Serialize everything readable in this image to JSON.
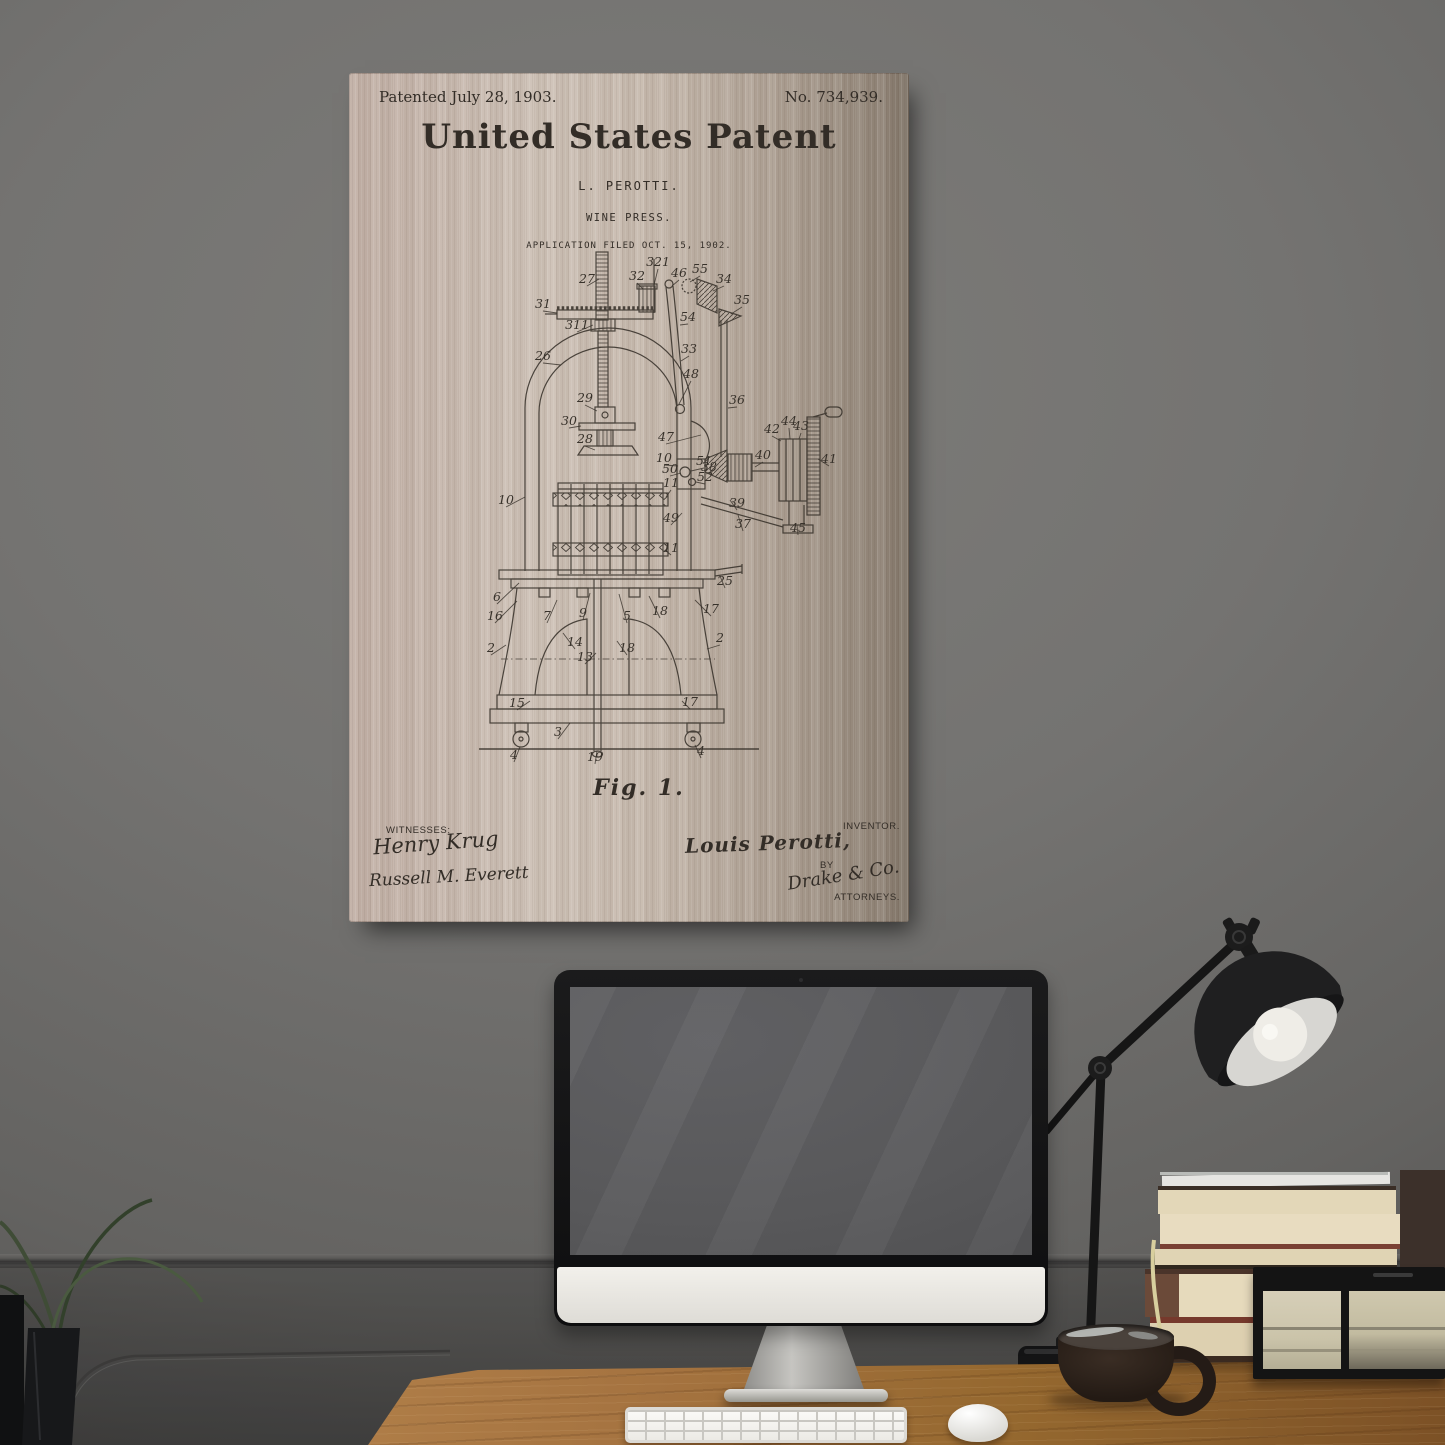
{
  "scene": {
    "description": "Wine press patent art print on brushed metal hanging on a dark gray wall above a desk with a computer, lamp, books, glass box, mug and plant",
    "objects": [
      "patent print",
      "desktop computer",
      "keyboard",
      "mouse",
      "desk lamp",
      "book stack",
      "glass display box",
      "coffee mug",
      "plant"
    ]
  },
  "colors": {
    "wall": "#747371",
    "wainscot": "#4e4d4c",
    "desk_wood": "#a57340",
    "poster_background": "#c8bbb0",
    "ink": "#38322b",
    "imac_bezel": "#141415",
    "imac_screen": "#58585a",
    "imac_chin": "#ece9e4",
    "lamp": "#1b1b1b",
    "bulb": "#efede7",
    "book_pages": "#e6dabc",
    "book_cover_red": "#77392c",
    "mug": "#2e241d",
    "glass_box_glass": "#cfc8ae"
  },
  "patent_print": {
    "header_left": "Patented July 28, 1903.",
    "header_right": "No. 734,939.",
    "title": "United States Patent",
    "inventor_name_line": "L. PEROTTI.",
    "invention_title": "WINE PRESS.",
    "application_line": "APPLICATION FILED OCT. 15, 1902.",
    "figure_label": "Fig. 1.",
    "witnesses_label": "WITNESSES:",
    "witness_signatures": [
      "Henry Krug",
      "Russell M. Everett"
    ],
    "inventor_label": "INVENTOR.",
    "inventor_signature": "Louis Perotti,",
    "by_label": "BY",
    "attorney_signature": "Drake & Co.",
    "attorneys_label": "ATTORNEYS.",
    "part_labels": [
      {
        "n": "27",
        "x": 238,
        "y": 210,
        "lx": 250,
        "ly": 206
      },
      {
        "n": "31",
        "x": 194,
        "y": 235,
        "lx": 208,
        "ly": 240
      },
      {
        "n": "311",
        "x": 228,
        "y": 256,
        "lx": 244,
        "ly": 252
      },
      {
        "n": "321",
        "x": 309,
        "y": 193,
        "lx": 305,
        "ly": 212
      },
      {
        "n": "32",
        "x": 288,
        "y": 207,
        "lx": 294,
        "ly": 216
      },
      {
        "n": "46",
        "x": 330,
        "y": 204,
        "lx": 323,
        "ly": 213
      },
      {
        "n": "55",
        "x": 351,
        "y": 200,
        "lx": 341,
        "ly": 209
      },
      {
        "n": "34",
        "x": 375,
        "y": 210,
        "lx": 364,
        "ly": 218
      },
      {
        "n": "35",
        "x": 393,
        "y": 231,
        "lx": 382,
        "ly": 241
      },
      {
        "n": "54",
        "x": 339,
        "y": 248,
        "lx": 331,
        "ly": 252
      },
      {
        "n": "26",
        "x": 194,
        "y": 287,
        "lx": 212,
        "ly": 292
      },
      {
        "n": "33",
        "x": 340,
        "y": 280,
        "lx": 332,
        "ly": 288
      },
      {
        "n": "48",
        "x": 342,
        "y": 305,
        "lx": 330,
        "ly": 331
      },
      {
        "n": "36",
        "x": 388,
        "y": 331,
        "lx": 379,
        "ly": 335
      },
      {
        "n": "29",
        "x": 236,
        "y": 329,
        "lx": 248,
        "ly": 338
      },
      {
        "n": "30",
        "x": 220,
        "y": 352,
        "lx": 232,
        "ly": 353
      },
      {
        "n": "28",
        "x": 236,
        "y": 370,
        "lx": 246,
        "ly": 377
      },
      {
        "n": "47",
        "x": 317,
        "y": 368,
        "lx": 352,
        "ly": 362
      },
      {
        "n": "10",
        "x": 315,
        "y": 389,
        "lx": 329,
        "ly": 393
      },
      {
        "n": "51",
        "x": 355,
        "y": 392,
        "lx": 342,
        "ly": 398
      },
      {
        "n": "50",
        "x": 321,
        "y": 400,
        "lx": 332,
        "ly": 400
      },
      {
        "n": "52",
        "x": 356,
        "y": 408,
        "lx": 347,
        "ly": 409
      },
      {
        "n": "11",
        "x": 322,
        "y": 414,
        "lx": 317,
        "ly": 424
      },
      {
        "n": "49",
        "x": 322,
        "y": 449,
        "lx": 333,
        "ly": 440
      },
      {
        "n": "10",
        "x": 157,
        "y": 431,
        "lx": 176,
        "ly": 424
      },
      {
        "n": "11",
        "x": 322,
        "y": 479,
        "lx": 316,
        "ly": 477
      },
      {
        "n": "38",
        "x": 360,
        "y": 398,
        "lx": 366,
        "ly": 396
      },
      {
        "n": "40",
        "x": 414,
        "y": 386,
        "lx": 406,
        "ly": 394
      },
      {
        "n": "44",
        "x": 440,
        "y": 352,
        "lx": 441,
        "ly": 366
      },
      {
        "n": "43",
        "x": 452,
        "y": 357,
        "lx": 450,
        "ly": 366
      },
      {
        "n": "42",
        "x": 423,
        "y": 360,
        "lx": 432,
        "ly": 368
      },
      {
        "n": "41",
        "x": 480,
        "y": 390,
        "lx": 469,
        "ly": 386
      },
      {
        "n": "39",
        "x": 388,
        "y": 434,
        "lx": 381,
        "ly": 427
      },
      {
        "n": "37",
        "x": 394,
        "y": 455,
        "lx": 389,
        "ly": 442
      },
      {
        "n": "45",
        "x": 449,
        "y": 459,
        "lx": 448,
        "ly": 452
      },
      {
        "n": "25",
        "x": 376,
        "y": 512,
        "lx": 371,
        "ly": 503
      },
      {
        "n": "6",
        "x": 148,
        "y": 528,
        "lx": 170,
        "ly": 510
      },
      {
        "n": "16",
        "x": 146,
        "y": 547,
        "lx": 168,
        "ly": 528
      },
      {
        "n": "7",
        "x": 198,
        "y": 547,
        "lx": 208,
        "ly": 527
      },
      {
        "n": "9",
        "x": 234,
        "y": 544,
        "lx": 241,
        "ly": 520
      },
      {
        "n": "5",
        "x": 278,
        "y": 547,
        "lx": 270,
        "ly": 521
      },
      {
        "n": "18",
        "x": 311,
        "y": 542,
        "lx": 300,
        "ly": 523
      },
      {
        "n": "17",
        "x": 362,
        "y": 540,
        "lx": 346,
        "ly": 527
      },
      {
        "n": "2",
        "x": 142,
        "y": 579,
        "lx": 157,
        "ly": 572
      },
      {
        "n": "2",
        "x": 371,
        "y": 569,
        "lx": 358,
        "ly": 576
      },
      {
        "n": "14",
        "x": 226,
        "y": 573,
        "lx": 214,
        "ly": 560
      },
      {
        "n": "13",
        "x": 236,
        "y": 588,
        "lx": 247,
        "ly": 580
      },
      {
        "n": "18",
        "x": 278,
        "y": 579,
        "lx": 268,
        "ly": 568
      },
      {
        "n": "15",
        "x": 168,
        "y": 634,
        "lx": 181,
        "ly": 628
      },
      {
        "n": "17",
        "x": 341,
        "y": 633,
        "lx": 333,
        "ly": 628
      },
      {
        "n": "3",
        "x": 209,
        "y": 663,
        "lx": 221,
        "ly": 650
      },
      {
        "n": "19",
        "x": 246,
        "y": 688,
        "lx": 248,
        "ly": 678
      },
      {
        "n": "4",
        "x": 165,
        "y": 686,
        "lx": 171,
        "ly": 674
      },
      {
        "n": "4",
        "x": 352,
        "y": 682,
        "lx": 346,
        "ly": 672
      }
    ]
  }
}
